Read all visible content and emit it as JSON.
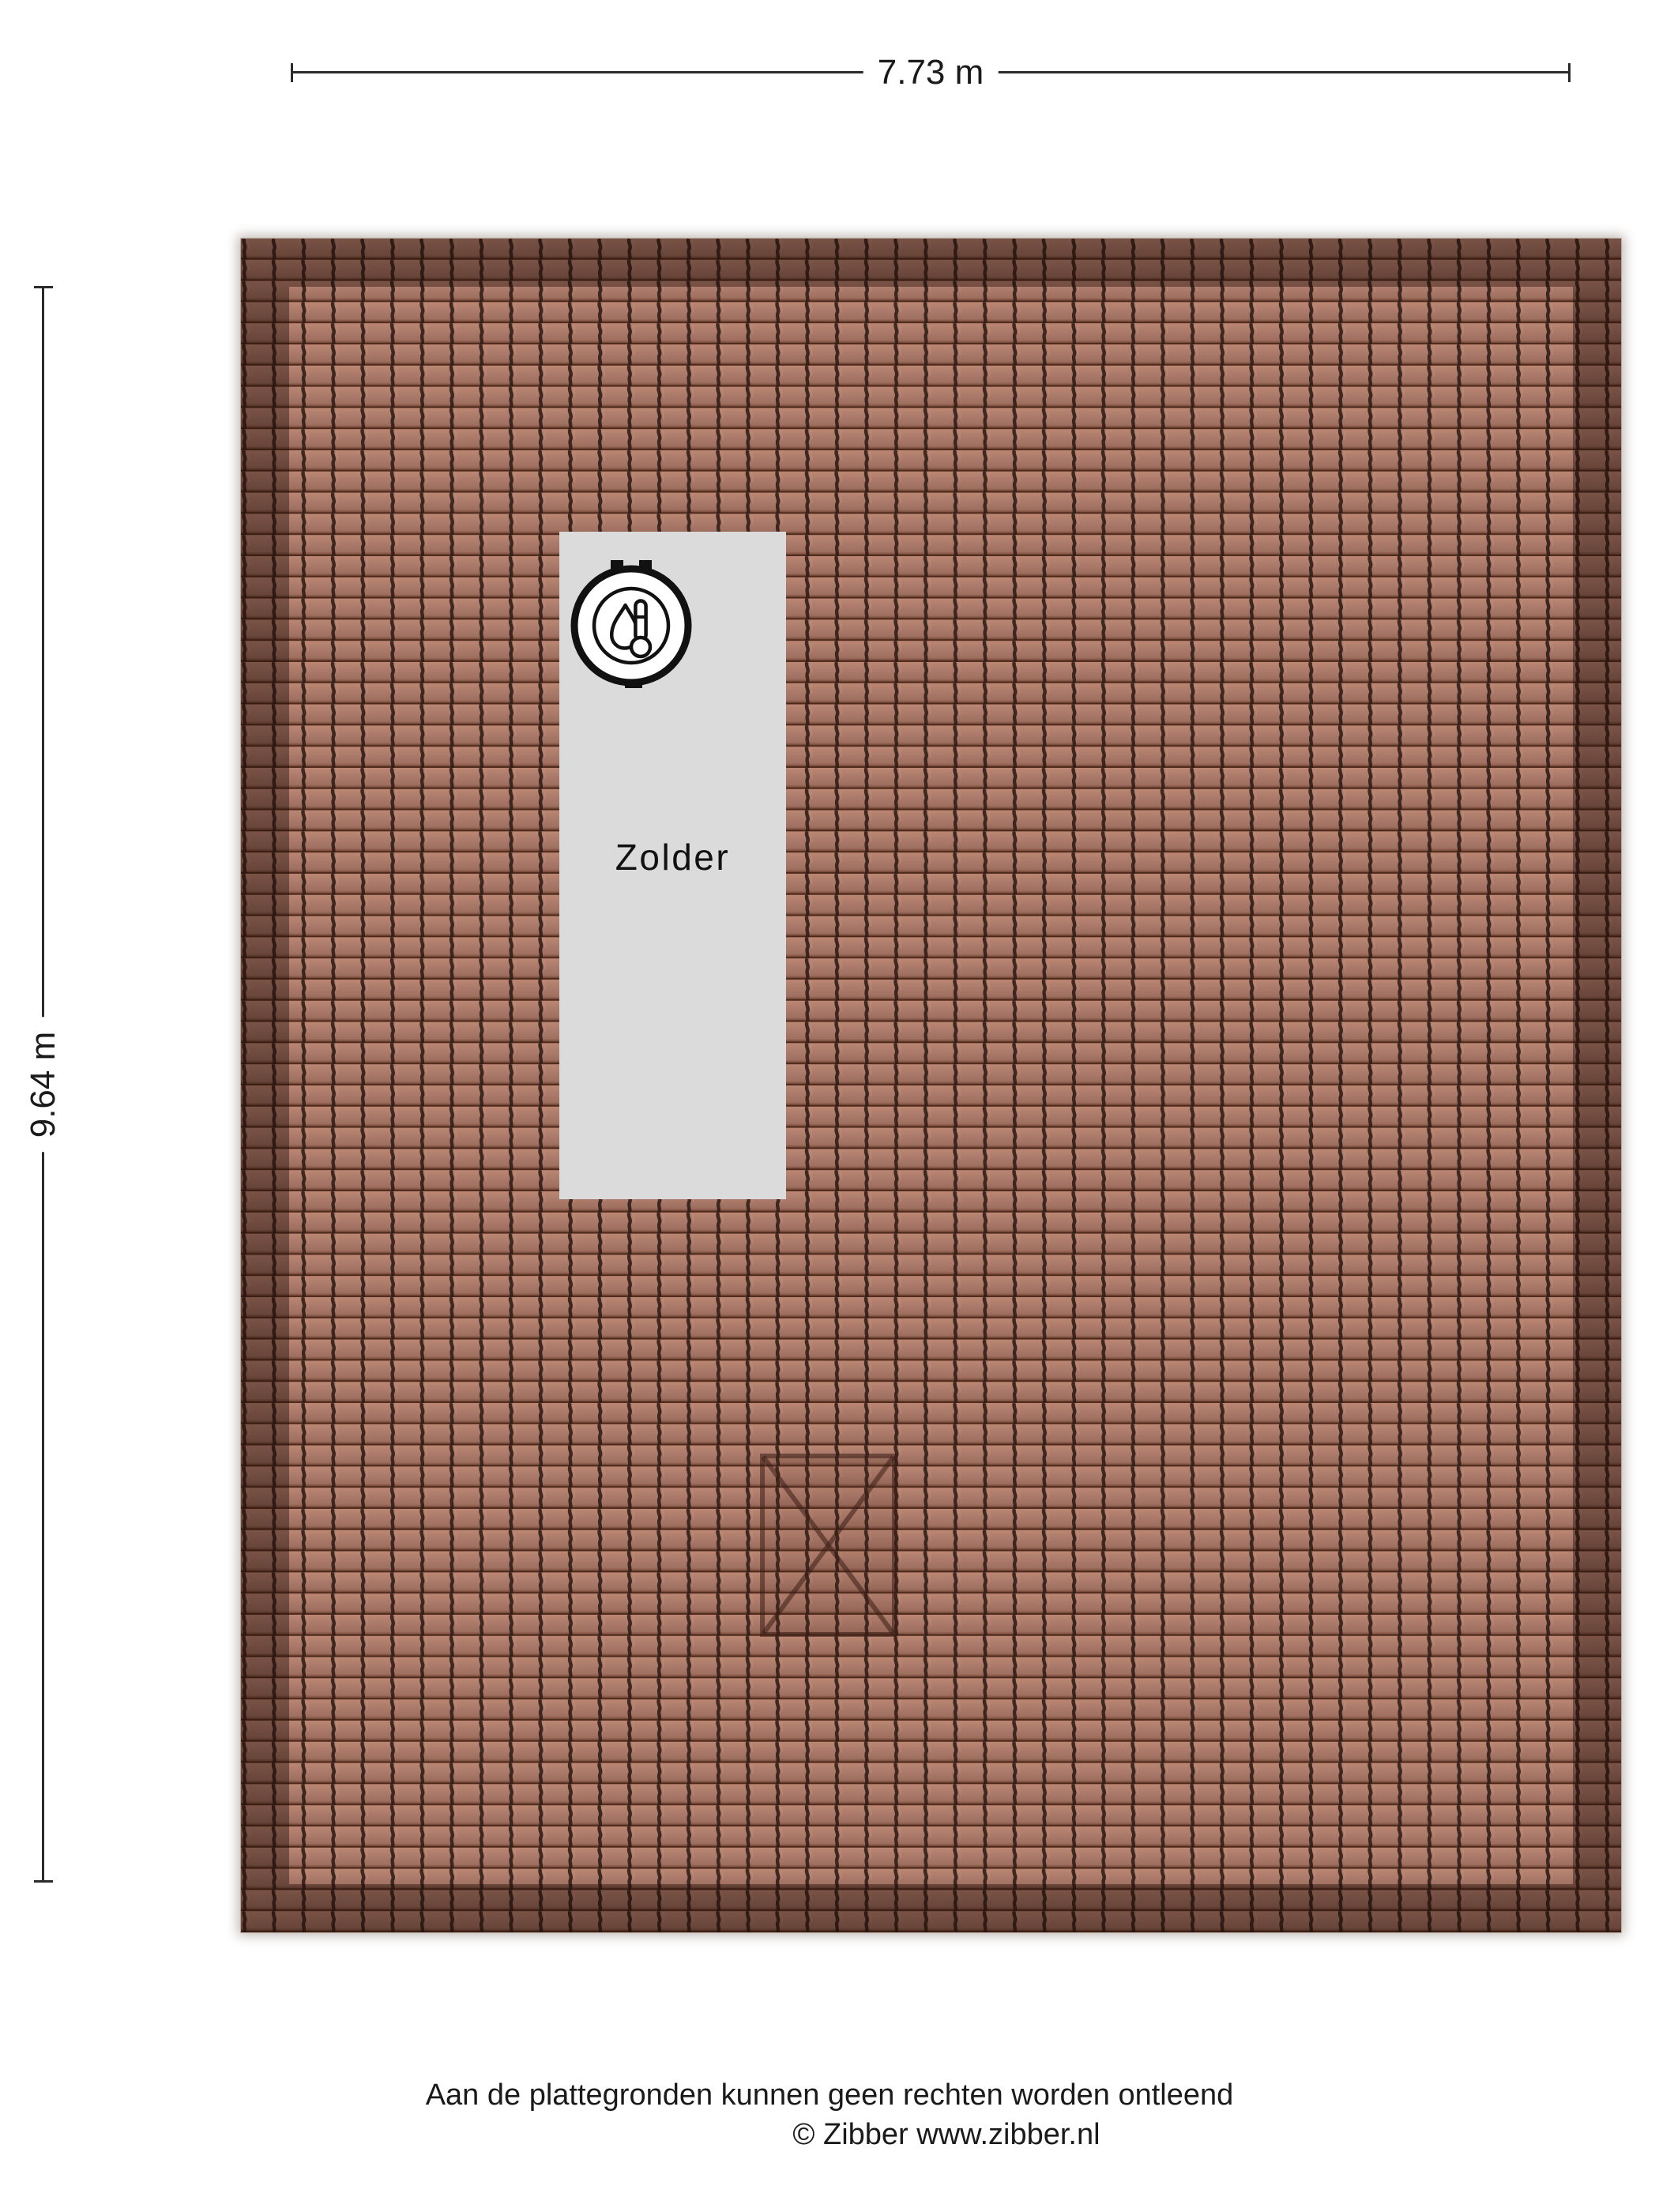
{
  "floorplan": {
    "dimensions": {
      "width_label": "7.73 m",
      "height_label": "9.64 m"
    },
    "room": {
      "label": "Zolder"
    },
    "icon": {
      "name": "heating-boiler-icon"
    },
    "footer": {
      "disclaimer": "Aan de plattegronden kunnen geen rechten worden ontleend",
      "copyright": "© Zibber www.zibber.nl"
    },
    "colors": {
      "tile_base": "#ab7a6a",
      "tile_groove": "#2f1b14",
      "roof_border_overlay": "rgba(30,13,7,0.42)",
      "room_fill": "#dbdbdb",
      "dimension_line": "#2b2b2b",
      "skylight_marker": "rgba(58,30,20,0.55)",
      "text": "#1a1a1a"
    }
  }
}
